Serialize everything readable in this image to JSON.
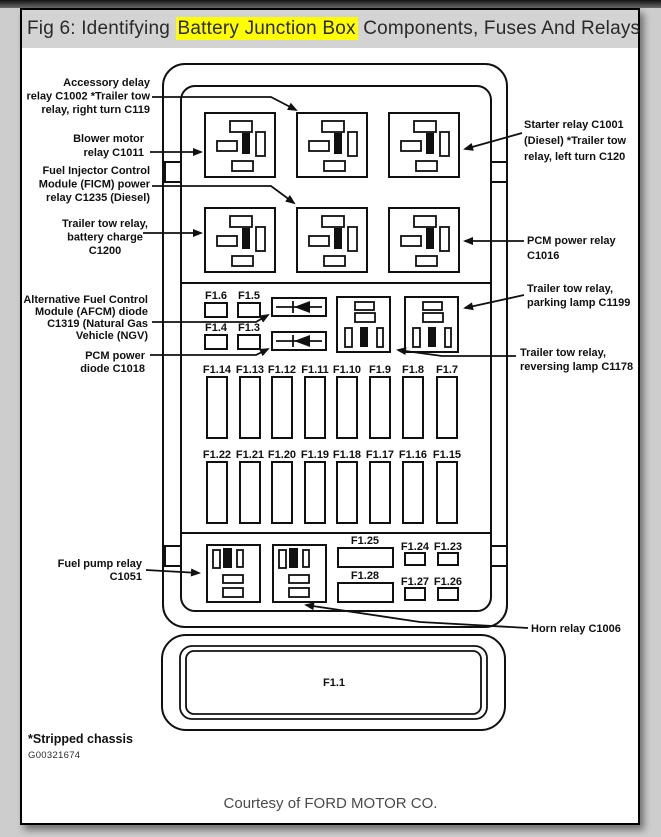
{
  "page": {
    "title": {
      "prefix": "Fig 6: Identifying ",
      "highlight": "Battery Junction Box",
      "suffix": " Components, Fuses And Relays"
    },
    "footnote": "*Stripped chassis",
    "figure_id": "G00321674",
    "credit": "Courtesy of FORD MOTOR CO.",
    "colors": {
      "highlight": "#ffff00",
      "titlebar_bg": "#d3d3d3",
      "line": "#101010"
    }
  },
  "diagram": {
    "callouts_left": [
      {
        "id": "accessory-delay-relay",
        "lines": [
          "Accessory delay",
          "relay C1002 *Trailer tow",
          "relay, right turn C119"
        ]
      },
      {
        "id": "blower-motor-relay",
        "lines": [
          "Blower motor",
          "relay C1011"
        ]
      },
      {
        "id": "ficm-power-relay",
        "lines": [
          "Fuel Injector Control",
          "Module (FICM) power",
          "relay C1235 (Diesel)"
        ]
      },
      {
        "id": "trailer-tow-battery-charge",
        "lines": [
          "Trailer tow relay,",
          "battery charge",
          "C1200"
        ]
      },
      {
        "id": "afcm-diode",
        "lines": [
          "Alternative Fuel Control",
          "Module (AFCM) diode",
          "C1319 (Natural Gas",
          "Vehicle (NGV)"
        ]
      },
      {
        "id": "pcm-power-diode",
        "lines": [
          "PCM power",
          "diode C1018"
        ]
      },
      {
        "id": "fuel-pump-relay",
        "lines": [
          "Fuel pump relay",
          "C1051"
        ]
      }
    ],
    "callouts_right": [
      {
        "id": "starter-relay",
        "lines": [
          "Starter relay C1001",
          "(Diesel) *Trailer tow",
          "relay, left turn C120"
        ]
      },
      {
        "id": "pcm-power-relay",
        "lines": [
          "PCM power relay",
          "C1016"
        ]
      },
      {
        "id": "trailer-tow-parking-lamp",
        "lines": [
          "Trailer tow relay,",
          "parking lamp C1199"
        ]
      },
      {
        "id": "trailer-tow-reversing-lamp",
        "lines": [
          "Trailer tow relay,",
          "reversing lamp C1178"
        ]
      },
      {
        "id": "horn-relay",
        "lines": [
          "Horn relay C1006"
        ]
      }
    ],
    "fuse_rows": {
      "row1": [
        "F1.14",
        "F1.13",
        "F1.12",
        "F1.11",
        "F1.10",
        "F1.9",
        "F1.8",
        "F1.7"
      ],
      "row2": [
        "F1.22",
        "F1.21",
        "F1.20",
        "F1.19",
        "F1.18",
        "F1.17",
        "F1.16",
        "F1.15"
      ]
    },
    "small_fuses_mid": [
      "F1.6",
      "F1.5",
      "F1.4",
      "F1.3"
    ],
    "bottom_fuses": {
      "wide": [
        "F1.25",
        "F1.28"
      ],
      "small": [
        "F1.24",
        "F1.23",
        "F1.27",
        "F1.26"
      ]
    },
    "main_fuse": "F1.1"
  }
}
